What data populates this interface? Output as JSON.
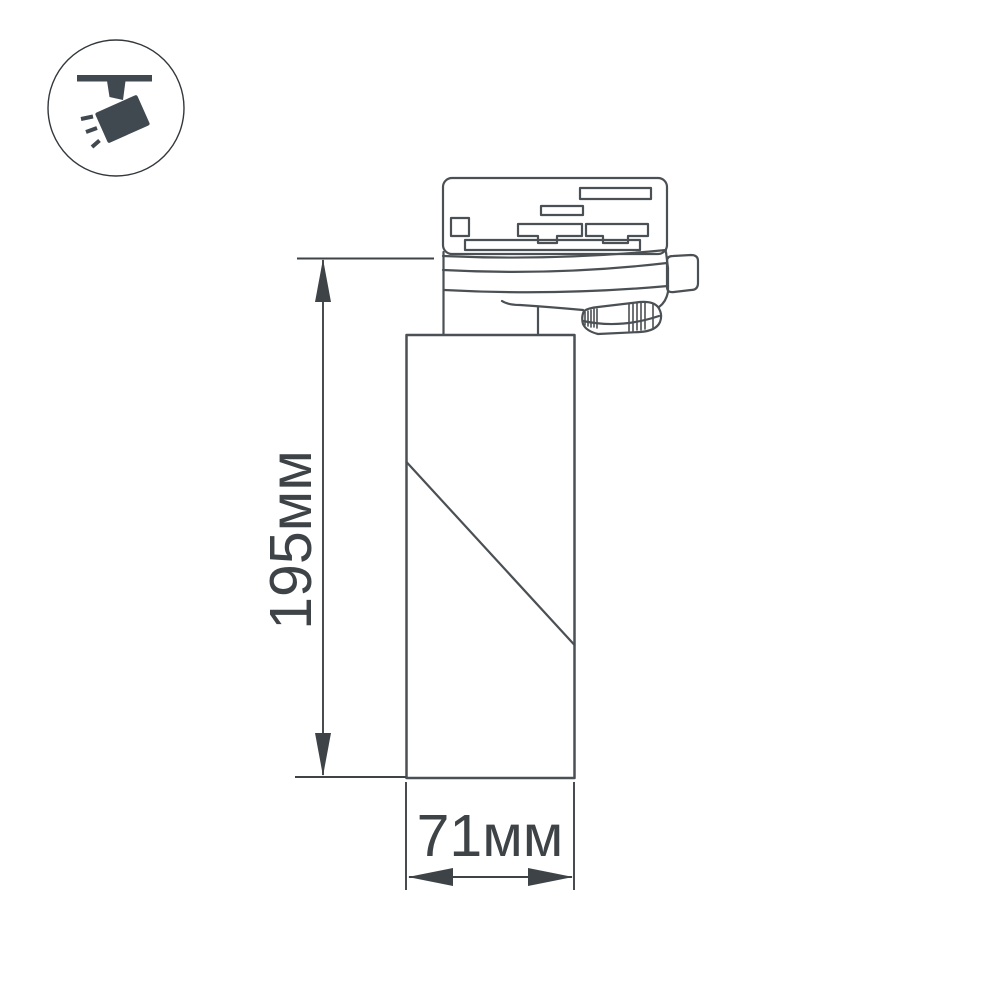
{
  "background": "#ffffff",
  "badge": {
    "icon": "track-spotlight-icon",
    "glyph_color": "#414950",
    "ring_color": "#33383c"
  },
  "drawing": {
    "stroke_color": "#4b5054",
    "dimension_color": "#3e4347",
    "height_dimension": {
      "label": "195мм",
      "value_mm": 195
    },
    "width_dimension": {
      "label": "71мм",
      "value_mm": 71
    }
  }
}
